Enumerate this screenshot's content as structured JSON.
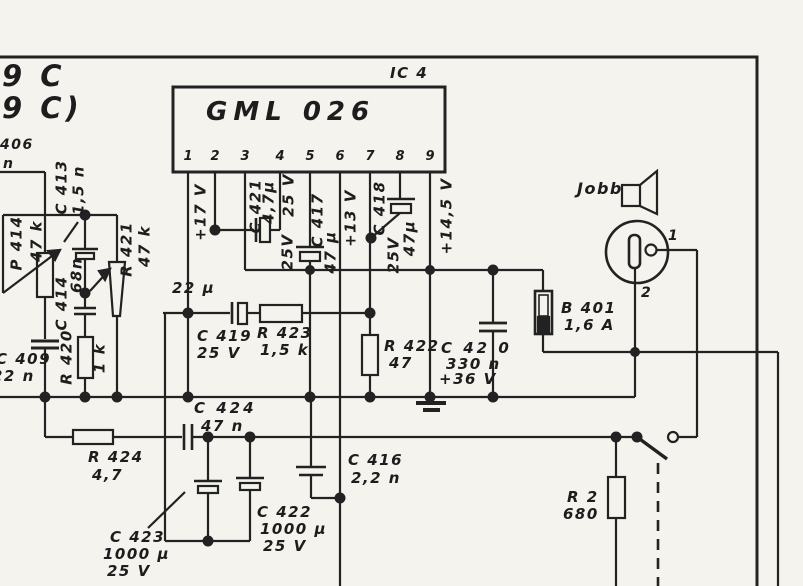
{
  "page": {
    "background": "#f4f3ee",
    "ink": "#1f1f1f"
  },
  "frame": {
    "partial_text_line1": "9 C",
    "partial_text_line2": "9 C)",
    "partial_component_ref": "406",
    "partial_component_value": "n"
  },
  "ic": {
    "ref": "IC 4",
    "name": "GML 026",
    "pins": [
      "1",
      "2",
      "3",
      "4",
      "5",
      "6",
      "7",
      "8",
      "9"
    ]
  },
  "rails": {
    "v17": "+17 V",
    "v13": "+13 V",
    "v145": "+14,5 V"
  },
  "components": {
    "c413": {
      "ref": "C 413",
      "value": "1,5 n"
    },
    "p414": {
      "ref": "P 414",
      "value": "47 k"
    },
    "r421": {
      "ref": "R 421",
      "value": "47 k"
    },
    "c414": {
      "ref": "C 414",
      "value": "68n"
    },
    "r420": {
      "ref": "R 420",
      "value": "1 k"
    },
    "c409": {
      "ref": "C 409",
      "value": "22 n"
    },
    "c421": {
      "ref": "C 421",
      "value": "4,7µ",
      "voltage": "25 V"
    },
    "c417": {
      "ref": "C 417",
      "value": "47 µ",
      "voltage": "25V"
    },
    "c418": {
      "ref": "C 418",
      "value": "47µ",
      "voltage": "25V"
    },
    "c419": {
      "ref": "C 419",
      "value": "22 µ",
      "voltage": "25 V"
    },
    "r423": {
      "ref": "R 423",
      "value": "1,5 k"
    },
    "r422": {
      "ref": "R 422",
      "value": "47"
    },
    "c420": {
      "ref": "C 42 0",
      "value": "330 n",
      "voltage": "+36 V"
    },
    "b401": {
      "ref": "B 401",
      "value": "1,6 A"
    },
    "speaker": {
      "label": "Jobb"
    },
    "connector": {
      "pin1": "1",
      "pin2": "2"
    },
    "r2": {
      "ref": "R 2",
      "value": "680"
    },
    "c424": {
      "ref": "C 424",
      "value": "47 n"
    },
    "r424": {
      "ref": "R 424",
      "value": "4,7"
    },
    "c423": {
      "ref": "C 423",
      "value": "1000 µ",
      "voltage": "25 V"
    },
    "c422": {
      "ref": "C 422",
      "value": "1000 µ",
      "voltage": "25 V"
    },
    "c416": {
      "ref": "C 416",
      "value": "2,2 n"
    }
  }
}
